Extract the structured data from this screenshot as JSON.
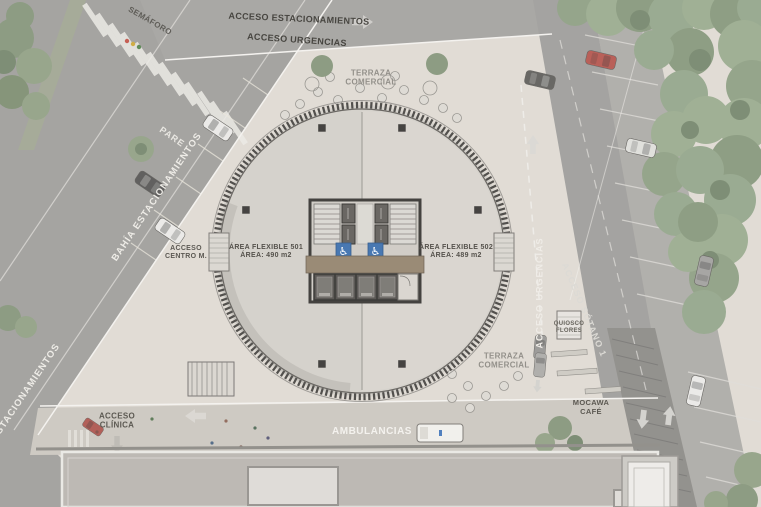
{
  "plan_labels": {
    "semaforo": "SEMÁFORO",
    "acceso_estacionamientos": "ACCESO ESTACIONAMIENTOS",
    "acceso_urgencias_top": "ACCESO URGENCIAS",
    "terraza_top_1": "TERRAZA",
    "terraza_top_2": "COMERCIAL",
    "pare": "PARE",
    "bahia_estacionamientos": "BAHÍA ESTACIONAMIENTOS",
    "estacionamientos_edge": "ESTACIONAMIENTOS",
    "acceso_centro_1": "ACCESO",
    "acceso_centro_2": "CENTRO M.",
    "area_501_1": "ÁREA FLEXIBLE 501",
    "area_501_2": "ÁREA: 490 m2",
    "area_502_1": "ÁREA FLEXIBLE 502",
    "area_502_2": "ÁREA: 489 m2",
    "acceso_urgencias_drive": "ACCESO URGENCIAS",
    "acceso_sotano": "ACCESO SÓTANO 1",
    "quiosco_1": "QUIOSCO",
    "quiosco_2": "FLORES",
    "terraza_bottom_1": "TERRAZA",
    "terraza_bottom_2": "COMERCIAL",
    "mocawa_1": "MOCAWA",
    "mocawa_2": "CAFÉ",
    "acceso_clinica_1": "ACCESO",
    "acceso_clinica_2": "CLÍNICA",
    "ambulancias": "AMBULANCIAS"
  },
  "icons": {
    "wheelchair": "♿",
    "arrow_right": "➜",
    "arrow_left": "⬅",
    "arrow_up": "⬆",
    "arrow_down": "⬇"
  },
  "palette": {
    "plaza": "#ddd8d0",
    "road": "#9e9c99",
    "road_dark": "#85837f",
    "trees": "#8da083",
    "tower_floor": "#cfcbc4",
    "tower_ring": "#3b3835",
    "corridor_brown": "#8d7c64",
    "accessible_blue": "#2f66a8",
    "marking_white": "#eae8e3"
  }
}
